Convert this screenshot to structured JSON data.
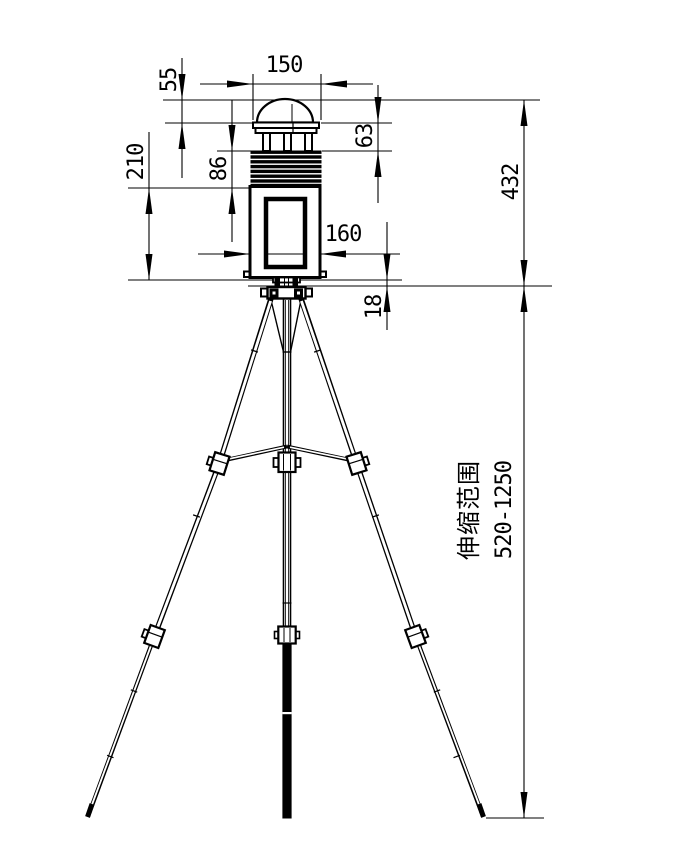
{
  "drawing": {
    "colors": {
      "ink": "#000000",
      "paper": "#ffffff"
    },
    "dims": {
      "width_cap": "150",
      "dome_h": "55",
      "cap_louver_h": "63",
      "louver_body_h": "86",
      "body_h": "210",
      "body_w": "160",
      "mount_h": "18",
      "total_h": "432",
      "range_label": "伸缩范围",
      "range_value": "520-1250"
    }
  }
}
